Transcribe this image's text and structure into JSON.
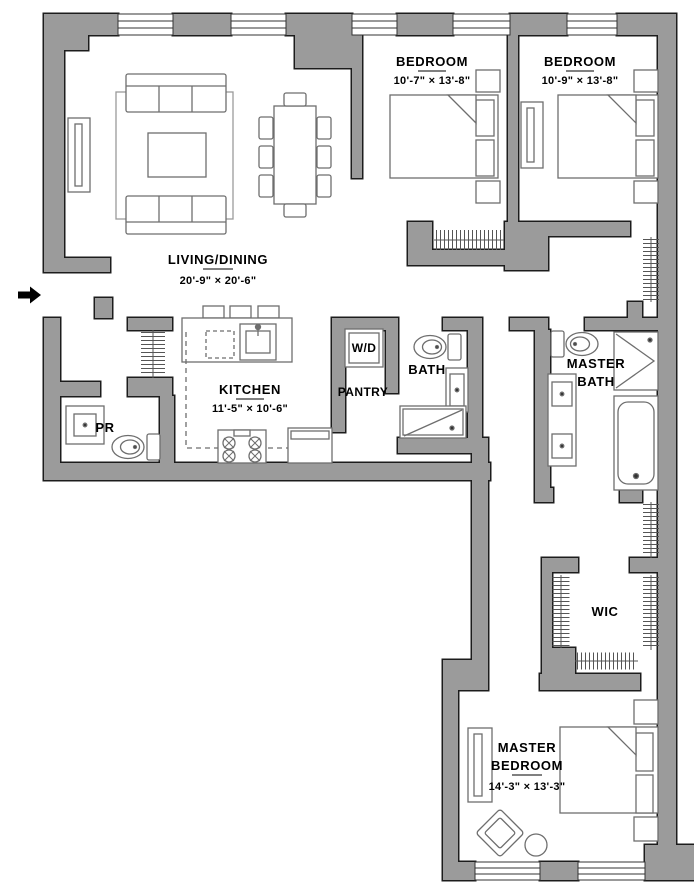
{
  "plan": {
    "type": "apartment-floor-plan",
    "colors": {
      "wall_fill": "#9b9b9b",
      "wall_outline": "#1c1c1c",
      "furniture_line": "#666666",
      "text": "#000000",
      "floor": "#ffffff"
    },
    "icons": {
      "entry_arrow": "right-arrow"
    }
  },
  "labels": {
    "living": {
      "name": "LIVING/DINING",
      "dims": "20'-9\" × 20'-6\""
    },
    "bedroom1": {
      "name": "BEDROOM",
      "dims": "10'-7\" × 13'-8\""
    },
    "bedroom2": {
      "name": "BEDROOM",
      "dims": "10'-9\" × 13'-8\""
    },
    "kitchen": {
      "name": "KITCHEN",
      "dims": "11'-5\" × 10'-6\""
    },
    "pantry": {
      "name": "PANTRY"
    },
    "bath": {
      "name": "BATH"
    },
    "wd": {
      "name": "W/D"
    },
    "pr": {
      "name": "PR"
    },
    "master_bath": {
      "name_line1": "MASTER",
      "name_line2": "BATH"
    },
    "wic": {
      "name": "WIC"
    },
    "master_bedroom": {
      "name_line1": "MASTER",
      "name_line2": "BEDROOM",
      "dims": "14'-3\" × 13'-3\""
    }
  }
}
